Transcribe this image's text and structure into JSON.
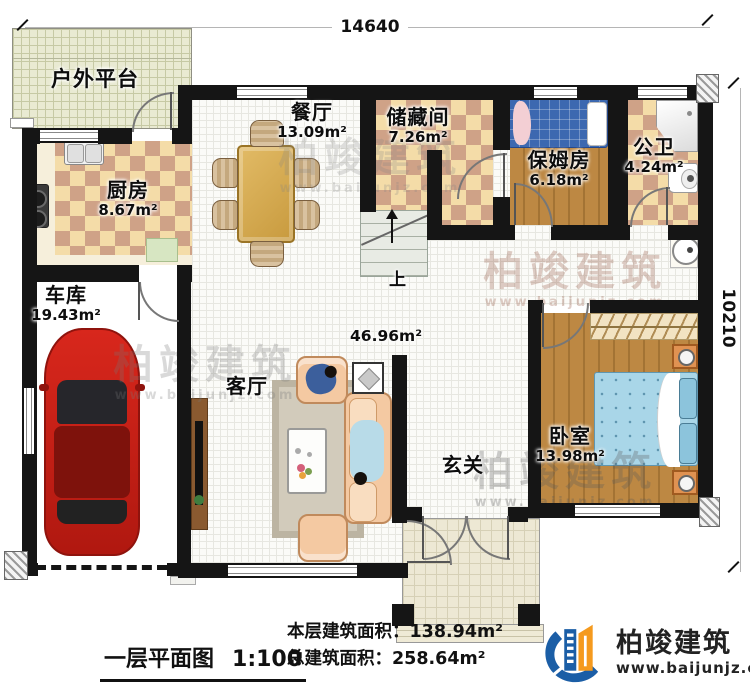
{
  "dimensions": {
    "top": "14640",
    "right": "10210"
  },
  "rooms": {
    "platform": {
      "name": "户外平台"
    },
    "kitchen": {
      "name": "厨房",
      "area": "8.67m²"
    },
    "dining": {
      "name": "餐厅",
      "area": "13.09m²"
    },
    "storage": {
      "name": "储藏间",
      "area": "7.26m²"
    },
    "nanny": {
      "name": "保姆房",
      "area": "6.18m²"
    },
    "bath": {
      "name": "公卫",
      "area": "4.24m²"
    },
    "garage": {
      "name": "车库",
      "area": "19.43m²"
    },
    "living": {
      "name": "客厅",
      "area": "46.96m²"
    },
    "foyer": {
      "name": "玄关"
    },
    "bedroom": {
      "name": "卧室",
      "area": "13.98m²"
    },
    "stairs": {
      "label": "上"
    }
  },
  "footer": {
    "title": "一层平面图",
    "scale": "1:100",
    "floor_area_label": "本层建筑面积：",
    "floor_area_value": "138.94m²",
    "total_area_label": "总建筑面积：",
    "total_area_value": "258.64m²"
  },
  "brand": {
    "name": "柏竣建筑",
    "website": "www.baijunjz.com"
  },
  "watermark": {
    "name": "柏竣建筑",
    "website": "www.baijunjz.com"
  },
  "colors": {
    "wall": "#151515",
    "checker_light": "#f4dca8",
    "checker_dark": "#cfa287",
    "wood": "#bd8843",
    "car_red": "#c41e16",
    "sofa": "#f4c9a2",
    "bed_blue": "#3c68b0",
    "bed_teal": "#a9d6e8",
    "logo_blue": "#1b5ea6",
    "logo_orange": "#f59a1e"
  }
}
